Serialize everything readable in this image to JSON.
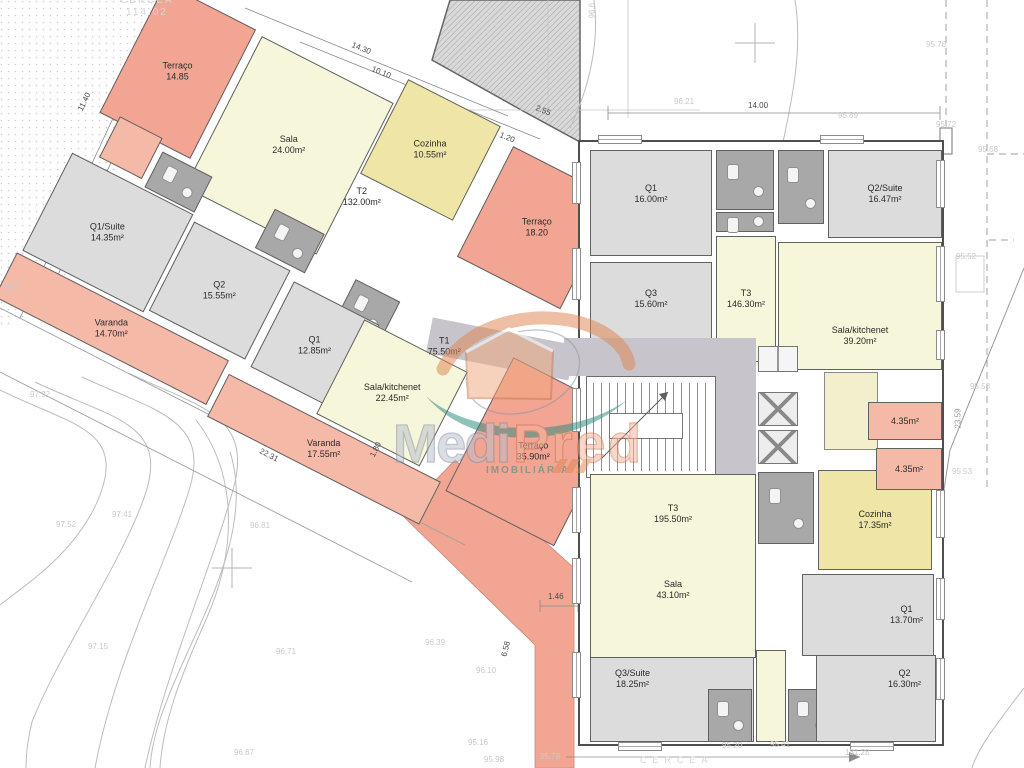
{
  "watermark": {
    "medi": "Medi",
    "pred": "Pred",
    "subtitle": "IMOBILIÁRIA"
  },
  "left_building": {
    "rooms": [
      {
        "name": "Terraço",
        "area": "14.85"
      },
      {
        "name": "Sala",
        "area": "24.00m²"
      },
      {
        "name": "Cozinha",
        "area": "10.55m²"
      },
      {
        "name": "T2",
        "area": "132.00m²"
      },
      {
        "name": "Q1/Suite",
        "area": "14.35m²"
      },
      {
        "name": "Q2",
        "area": "15.55m²"
      },
      {
        "name": "Q1",
        "area": "12.85m²"
      },
      {
        "name": "Varanda",
        "area": "14.70m²"
      },
      {
        "name": "T1",
        "area": "75.50m²"
      },
      {
        "name": "Sala/kitchenet",
        "area": "22.45m²"
      },
      {
        "name": "Varanda",
        "area": "17.55m²"
      },
      {
        "name": "Terraço",
        "area": "18.20"
      },
      {
        "name": "Terraço",
        "area": "35.90m²"
      }
    ]
  },
  "right_building": {
    "rooms": [
      {
        "name": "Q1",
        "area": "16.00m²"
      },
      {
        "name": "Q2/Suite",
        "area": "16.47m²"
      },
      {
        "name": "Q3",
        "area": "15.60m²"
      },
      {
        "name": "T3",
        "area": "146.30m²"
      },
      {
        "name": "Sala/kitchenet",
        "area": "39.20m²"
      },
      {
        "name": "T3",
        "area": "195.50m²"
      },
      {
        "name": "Sala",
        "area": "43.10m²"
      },
      {
        "name": "Cozinha",
        "area": "17.35m²"
      },
      {
        "name": "",
        "area": "4.35m²"
      },
      {
        "name": "",
        "area": "4.35m²"
      },
      {
        "name": "Q1",
        "area": "13.70m²"
      },
      {
        "name": "Q3/Suite",
        "area": "18.25m²"
      },
      {
        "name": "Q2",
        "area": "16.30m²"
      }
    ]
  },
  "dims": [
    "14.30",
    "10.10",
    "11.40",
    "14.00",
    "2.55",
    "1.20",
    "22.31",
    "1.46",
    "6.58",
    "1.80",
    "23.59",
    "181.28"
  ],
  "elevations": [
    "97.92",
    "97.52",
    "97.41",
    "97.15",
    "96.81",
    "96.71",
    "96.67",
    "96.39",
    "96.10",
    "95.16",
    "95.98",
    "95.78",
    "96.21",
    "95.89",
    "95.76",
    "95.72",
    "95.68",
    "95.52",
    "95.58",
    "95.53",
    "95.20",
    "95.41",
    "96.6",
    "102"
  ],
  "site": {
    "fence_label_top": "CERCEA",
    "fence_value_top": "114.02",
    "fence_label_bottom": "CERCEA"
  },
  "colors": {
    "terrace": "#f2a592",
    "balcony": "#f5b9a8",
    "living": "#f6f6da",
    "kitchen": "#eee5a7",
    "bedroom": "#dcdcdc",
    "bathroom": "#a8a8a8",
    "corridor": "#c7c5cb",
    "wall": "#5a5a5a",
    "watermark-orange": "#e08552",
    "watermark-teal": "#2c8b80",
    "watermark-gray": "#8d93a2"
  }
}
